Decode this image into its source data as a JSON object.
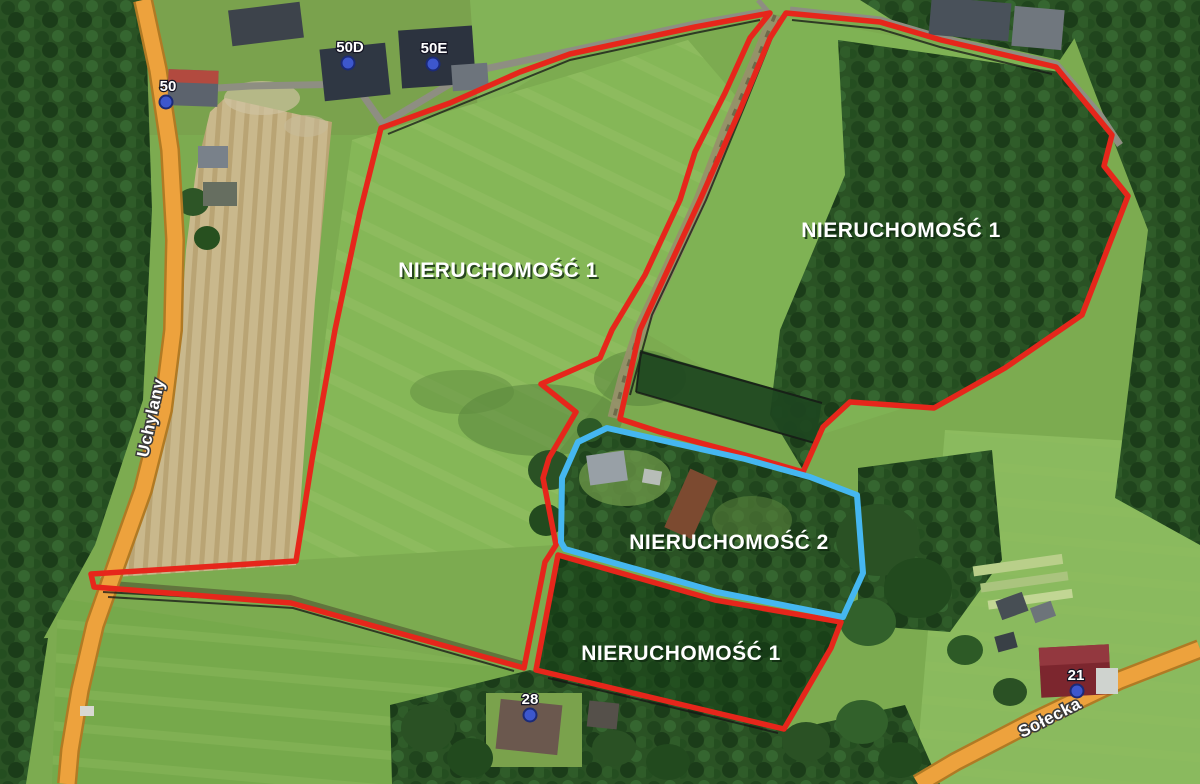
{
  "map": {
    "property_labels": [
      {
        "id": "property1-left",
        "text": "NIERUCHOMOŚĆ 1"
      },
      {
        "id": "property1-right",
        "text": "NIERUCHOMOŚĆ 1"
      },
      {
        "id": "property2",
        "text": "NIERUCHOMOŚĆ 2"
      },
      {
        "id": "property1-bottom",
        "text": "NIERUCHOMOŚĆ 1"
      }
    ],
    "street_labels": [
      {
        "id": "uchylany",
        "text": "Uchylany"
      },
      {
        "id": "solecka",
        "text": "Sołecka"
      }
    ],
    "house_markers": [
      {
        "label": "50"
      },
      {
        "label": "50D"
      },
      {
        "label": "50E"
      },
      {
        "label": "28"
      },
      {
        "label": "21"
      }
    ],
    "colors": {
      "property1_outline": "#e6261b",
      "property2_outline": "#45b7f0",
      "road_fill": "#eda23d",
      "road_casing": "#b07a24",
      "marker_dot": "#3d57cd",
      "label_text": "#ffffff"
    }
  }
}
